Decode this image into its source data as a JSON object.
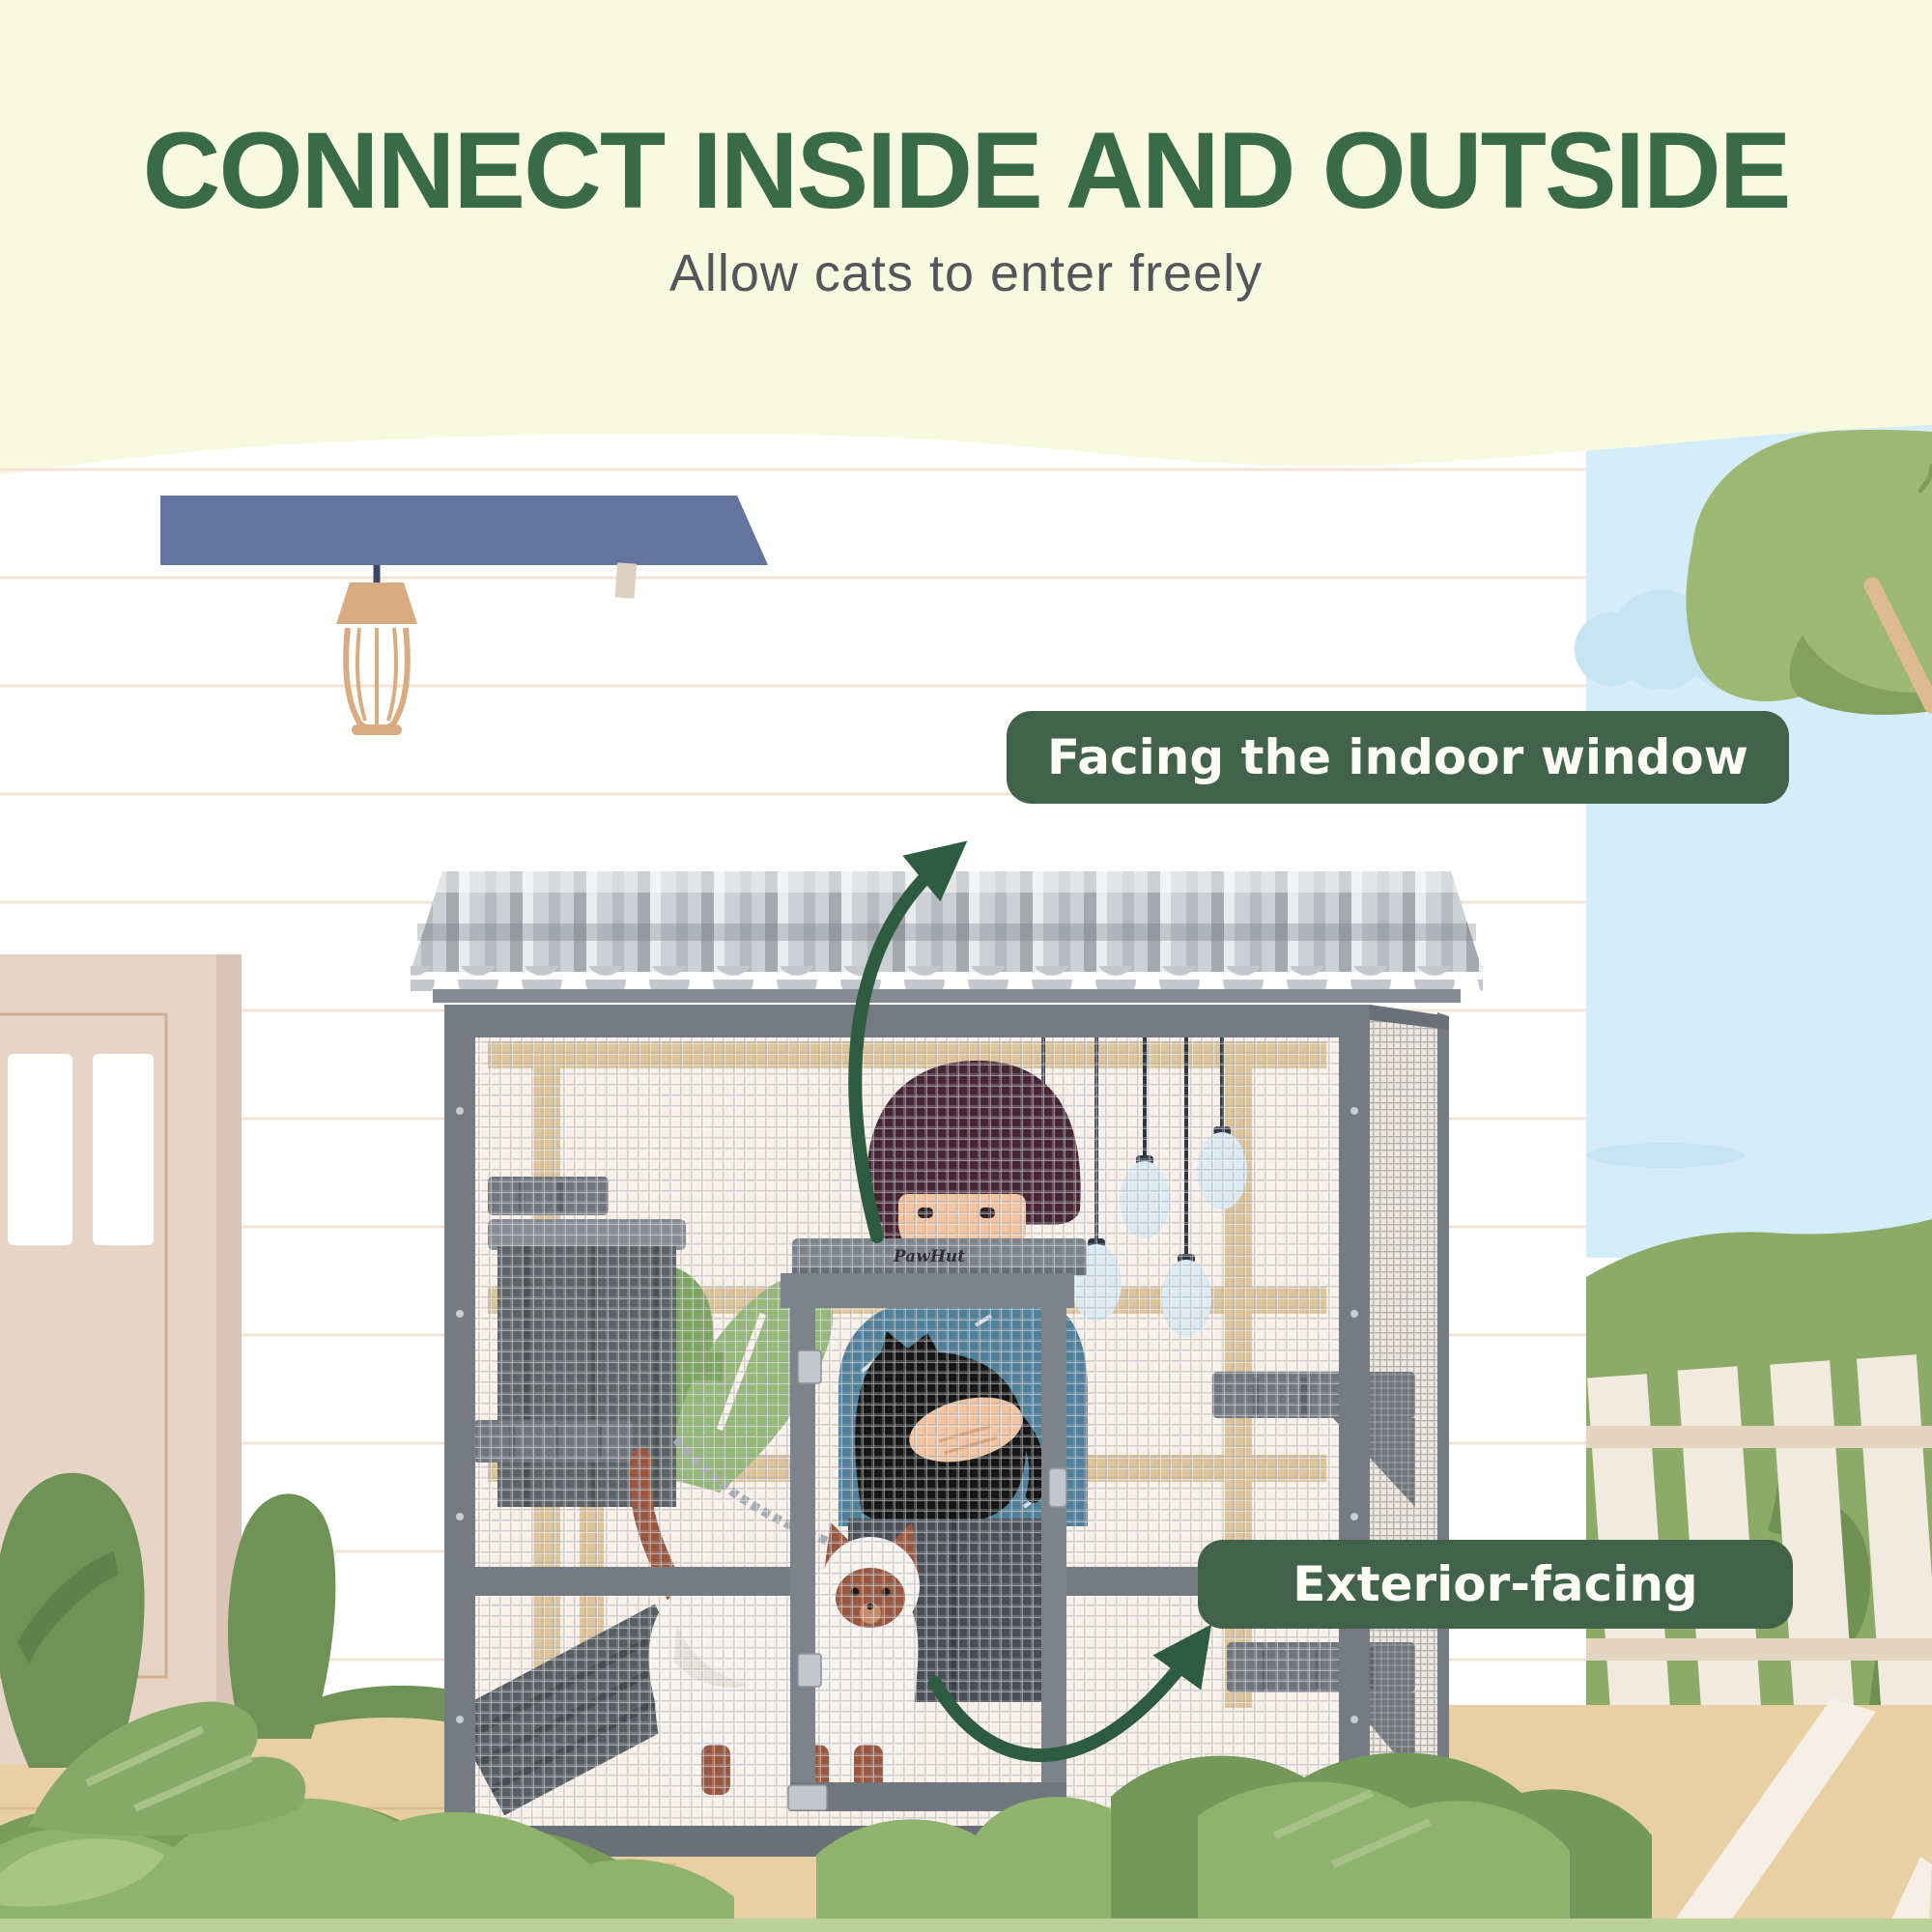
{
  "header": {
    "title": "CONNECT INSIDE AND OUTSIDE",
    "subtitle": "Allow cats to enter freely"
  },
  "callouts": {
    "indoor": {
      "label": "Facing the indoor window"
    },
    "exterior": {
      "label": "Exterior-facing"
    }
  },
  "product": {
    "brand_logo": "PawHut"
  },
  "icons": {
    "indoor_arrow": "curved-arrow-up-icon",
    "exterior_arrow": "curved-arrow-up-icon"
  },
  "colors": {
    "title_green": "#3a6b48",
    "subtitle_gray": "#55565b",
    "callout_bg": "#41634a",
    "callout_text": "#fdfdf6",
    "arrow_green": "#2e5c40",
    "top_band": "#f8fadf",
    "sky_blue": "#d5edf8",
    "hedge_green": "#8cab68",
    "deck_tan": "#e9cfa4",
    "awning_slate": "#65749e",
    "cage_gray": "#757b82"
  }
}
